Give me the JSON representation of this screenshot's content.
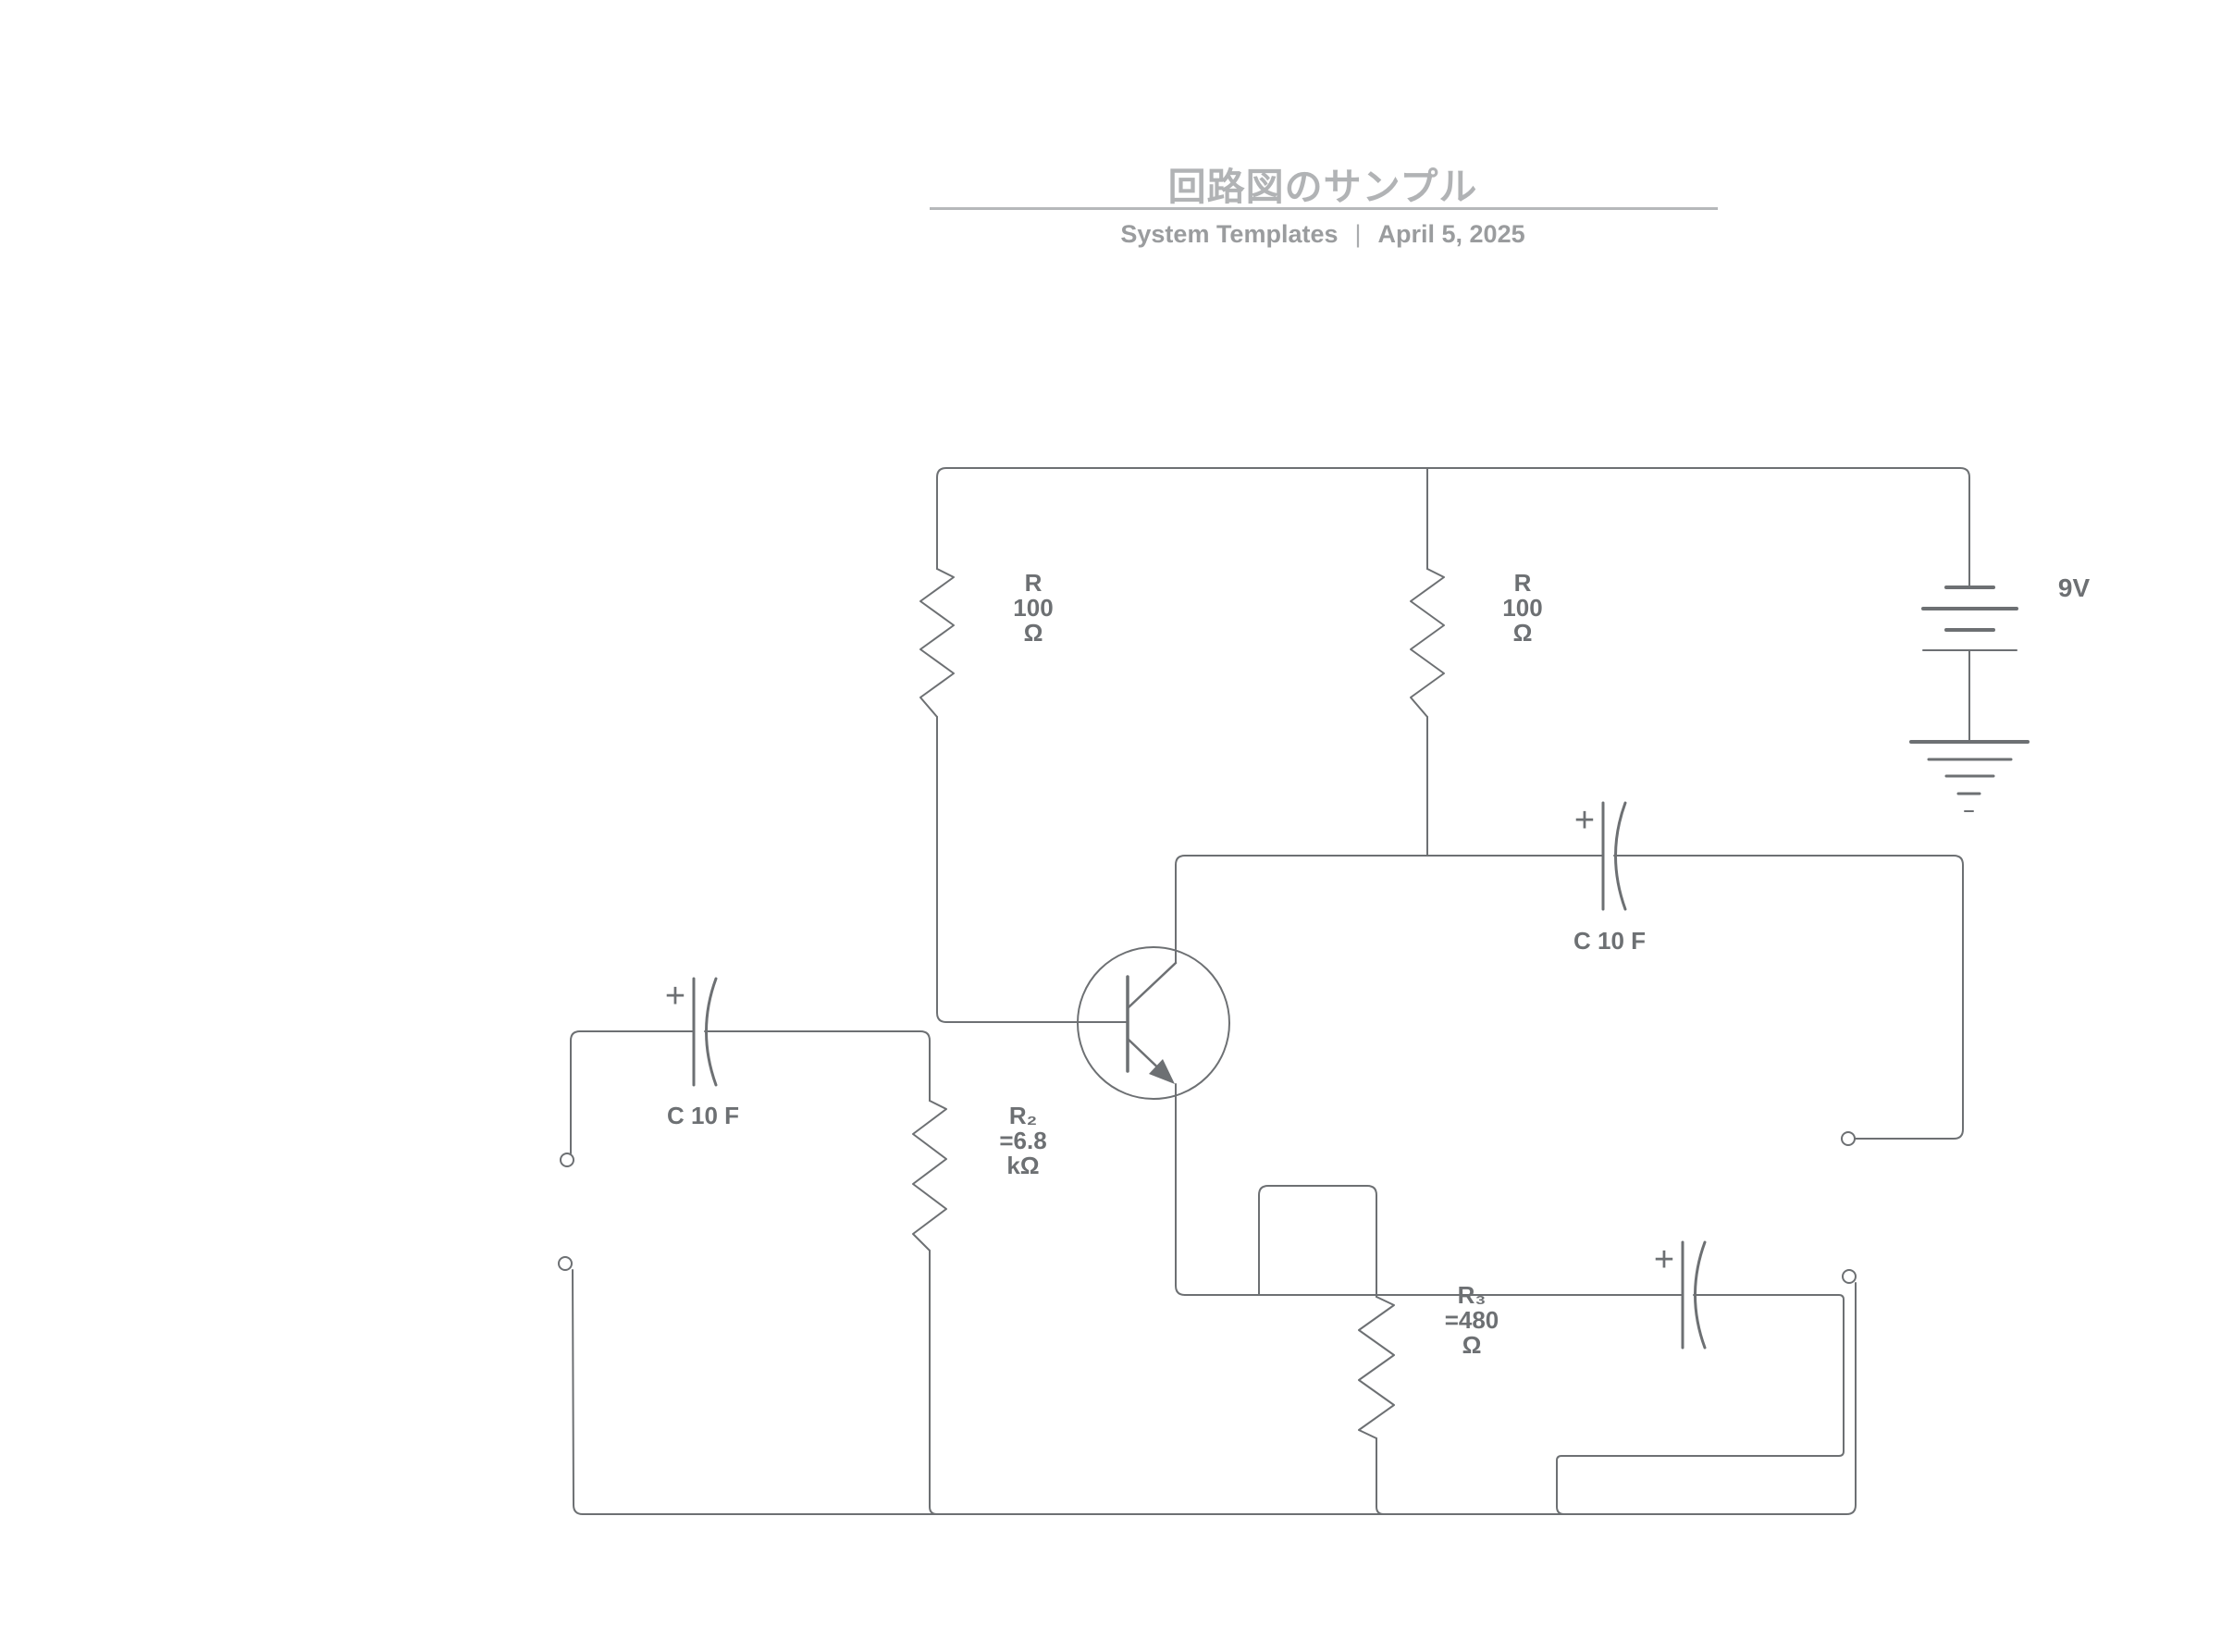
{
  "header": {
    "title": "回路図のサンプル",
    "meta": {
      "left": "System Templates",
      "divider": "|",
      "right": "April 5, 2025"
    }
  },
  "diagram": {
    "resistors": [
      {
        "id": "r-top-left",
        "label": "R\n100\nΩ"
      },
      {
        "id": "r-top-middle",
        "label": "R\n100\nΩ"
      },
      {
        "id": "r2",
        "label": "R₂\n=6.8\nkΩ"
      },
      {
        "id": "r3",
        "label": "R₃\n=480\nΩ"
      }
    ],
    "capacitors": [
      {
        "id": "c-input",
        "label": "C 10 F",
        "polarity": "+"
      },
      {
        "id": "c-top",
        "label": "C 10 F",
        "polarity": "+"
      },
      {
        "id": "c-output",
        "label": "",
        "polarity": "+"
      }
    ],
    "battery": {
      "label": "9V"
    },
    "transistor": {
      "type": "npn"
    },
    "colors": {
      "wire": "#6d7073",
      "component_label": "#6d7073",
      "title": "#b1b3b5",
      "separator": "#b6b8ba",
      "meta_text": "#9a9c9e",
      "background": "#ffffff"
    }
  }
}
